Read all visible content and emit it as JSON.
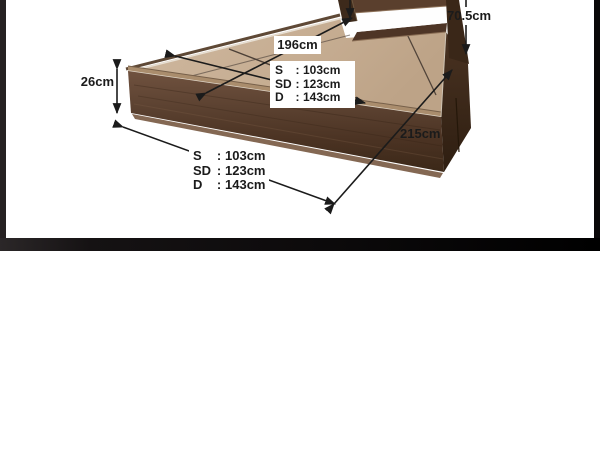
{
  "photo": {
    "top_clipped_label": "cm",
    "headboard_height_label": "70.5cm",
    "frame_height_label": "26cm",
    "inner_length_label": "196cm",
    "length_label": "215cm",
    "size_rows": [
      {
        "key": "S",
        "sep": ":",
        "value": "103cm"
      },
      {
        "key": "SD",
        "sep": ":",
        "value": "123cm"
      },
      {
        "key": "D",
        "sep": ":",
        "value": "143cm"
      }
    ]
  },
  "colors": {
    "wood_front": "#54392a",
    "wood_deck": "#c9b199",
    "frame_bars": "#141112",
    "annotation": "#1b1b1b"
  }
}
